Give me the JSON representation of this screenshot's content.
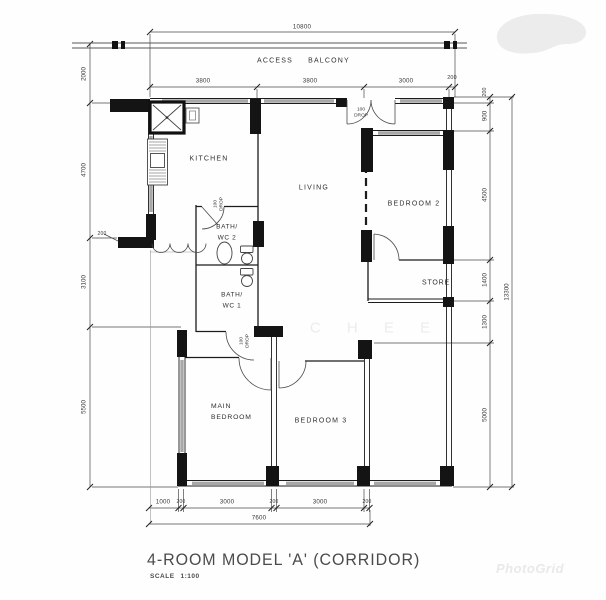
{
  "plan": {
    "balcony": {
      "access": "ACCESS",
      "balcony": "BALCONY"
    },
    "rooms": {
      "kitchen": "KITCHEN",
      "living": "LIVING",
      "bedroom2": "BEDROOM 2",
      "store": "STORE",
      "bath2_l1": "BATH/",
      "bath2_l2": "WC 2",
      "bath1_l1": "BATH/",
      "bath1_l2": "WC 1",
      "main_l1": "MAIN",
      "main_l2": "BEDROOM",
      "bedroom3": "BEDROOM 3"
    },
    "drop": {
      "l1": "100",
      "l2": "DROP"
    },
    "dims": {
      "top_total": "10800",
      "top_segs": [
        "3800",
        "3800",
        "3000",
        "200"
      ],
      "left": [
        "2000",
        "4700",
        "3100",
        "5500"
      ],
      "right": [
        "200",
        "900",
        "4500",
        "1400",
        "1300",
        "5000"
      ],
      "right_total": "13300",
      "bottom_segs": [
        "1000",
        "200",
        "3000",
        "200",
        "3000",
        "200"
      ],
      "bottom_total": "7600",
      "stub": "200"
    },
    "title": {
      "text": "4-ROOM MODEL 'A' (CORRIDOR)",
      "scale_label": "SCALE",
      "scale_value": "1:100"
    },
    "watermarks": {
      "center": "C H E E",
      "photogrid": "PhotoGrid"
    }
  }
}
